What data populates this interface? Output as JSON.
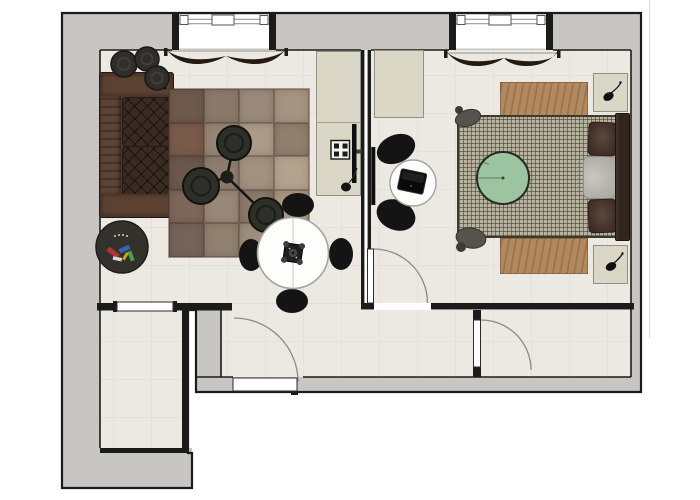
{
  "meta": {
    "drawing_type": "apartment-floor-plan-top-view",
    "canvas": {
      "width": 700,
      "height": 500
    }
  },
  "palette": {
    "wall_fill": "#c7c6c3",
    "wall_line": "#1b1b19",
    "floor": "#ece8e2",
    "floor_grid": "#ded9d2",
    "door_arc": "#8c8c88",
    "cabinet": "#dad7c7",
    "cabinet_line": "#8f8f85",
    "sofa": "#4b3328",
    "sofa_cushion": "#3b2a21",
    "curtain": "#241a12",
    "duvet": "#b8b29f",
    "bed_runner": "#b18a62",
    "pillow": "#49342a",
    "headboard": "#33241d",
    "green_throw": "#9dc4a0",
    "chair_black": "#141414",
    "table_white": "#fdfdfc"
  },
  "plan": {
    "rooms": [
      {
        "id": "living-room",
        "furniture": [
          "sofa",
          "patchwork-rug",
          "pouf-cluster",
          "nesting-coffee-tables",
          "magazine-basket",
          "dining-table",
          "dining-chairs-x4",
          "table-centerpiece",
          "sideboard",
          "wall-tv",
          "wall-art",
          "window-curtain"
        ]
      },
      {
        "id": "bedroom",
        "furniture": [
          "double-bed",
          "headboard",
          "pillows-x2",
          "duvet-fold",
          "green-round-throw",
          "bed-runner-rug",
          "nightstand-top",
          "nightstand-bottom",
          "plant-x2",
          "wardrobe",
          "desk-table",
          "desk-chairs-x2",
          "laptop",
          "wall-tv",
          "window-curtain",
          "foot-throws"
        ]
      },
      {
        "id": "hallway",
        "furniture": []
      },
      {
        "id": "entry-room",
        "furniture": []
      }
    ],
    "doors": [
      {
        "id": "entrance-door",
        "state": "open",
        "swing": "quarter-arc"
      },
      {
        "id": "bedroom-door",
        "state": "open",
        "swing": "quarter-arc"
      },
      {
        "id": "hallway-door",
        "state": "open",
        "swing": "quarter-arc"
      },
      {
        "id": "entry-room-door",
        "state": "closed",
        "swing": "none"
      }
    ],
    "windows": [
      {
        "id": "living-room-window",
        "wall": "top"
      },
      {
        "id": "bedroom-window",
        "wall": "top"
      }
    ]
  },
  "living_rug": {
    "cols": 4,
    "rows": 5,
    "patches": [
      "#6e5a4d",
      "#8a7a6b",
      "#9a8a7a",
      "#a59482",
      "#7a5b4b",
      "#968573",
      "#ab9b89",
      "#8f7f6f",
      "#6b584c",
      "#8d7d70",
      "#a2917e",
      "#b3a28e",
      "#7d675a",
      "#998878",
      "#8a7a6a",
      "#a89883",
      "#75635a",
      "#90806f",
      "#9d8d7c",
      "#92826f"
    ]
  },
  "basket_contents": [
    {
      "color": "#b5342e"
    },
    {
      "color": "#3663b5"
    },
    {
      "color": "#46a24e"
    },
    {
      "color": "#d8d8d2"
    },
    {
      "color": "#c9a227"
    }
  ]
}
